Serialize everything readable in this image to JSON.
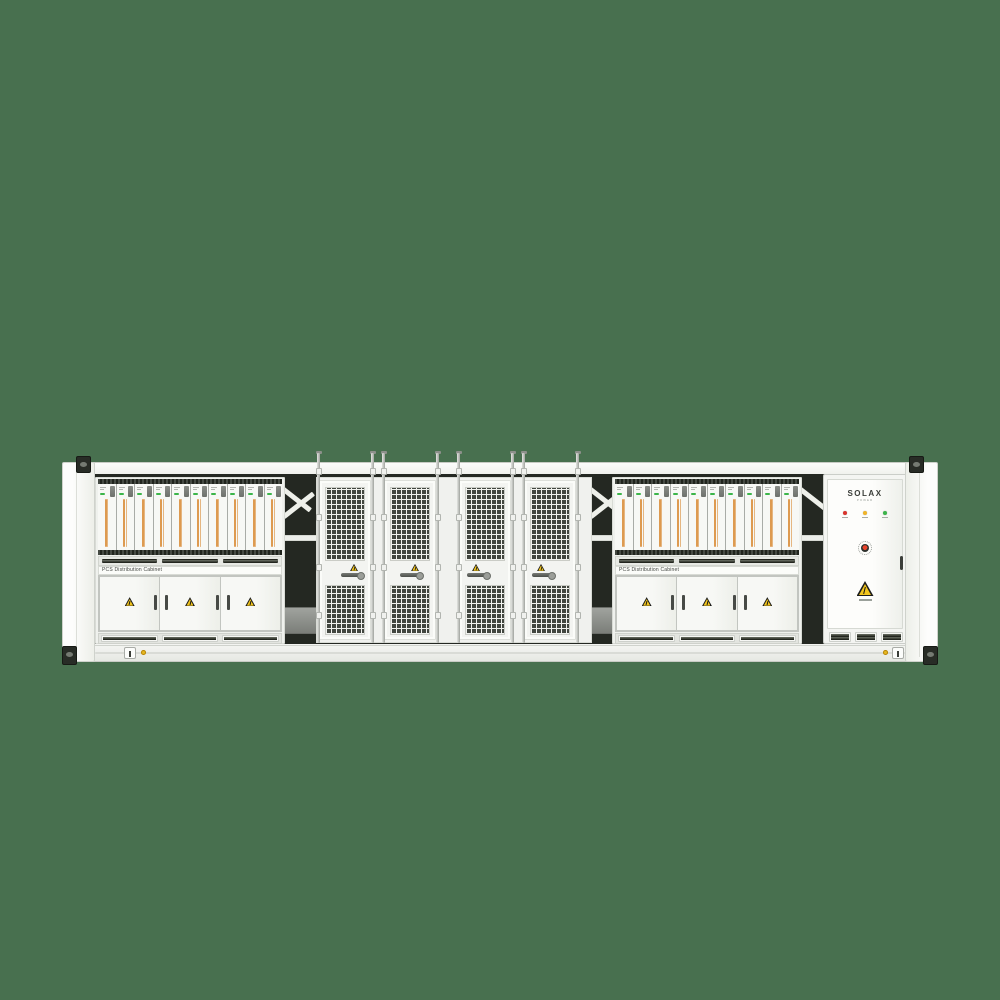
{
  "colors": {
    "background": "#48704f",
    "stripe_orange": "#dd9a50",
    "led_green": "#3cb54a",
    "warn_yellow": "#f2c51c",
    "estop_red": "#e8432b",
    "dot_yellow": "#e6b821",
    "mesh_dark": "#42463f"
  },
  "bays": [
    {
      "side": "left",
      "label": "PCS Distribution Cabinet",
      "module_count": 10,
      "door_count": 3
    },
    {
      "side": "right",
      "label": "PCS Distribution Cabinet",
      "module_count": 10,
      "door_count": 3
    }
  ],
  "mesh_section": {
    "door_count": 4,
    "handle_align": [
      "right",
      "center",
      "left",
      "left"
    ]
  },
  "control_cabinet": {
    "brand": "SOLAX",
    "brand_sub": "POWER",
    "leds": [
      {
        "name": "red",
        "color": "#d9342c"
      },
      {
        "name": "amber",
        "color": "#f0b429"
      },
      {
        "name": "green",
        "color": "#3cb54a"
      }
    ]
  }
}
